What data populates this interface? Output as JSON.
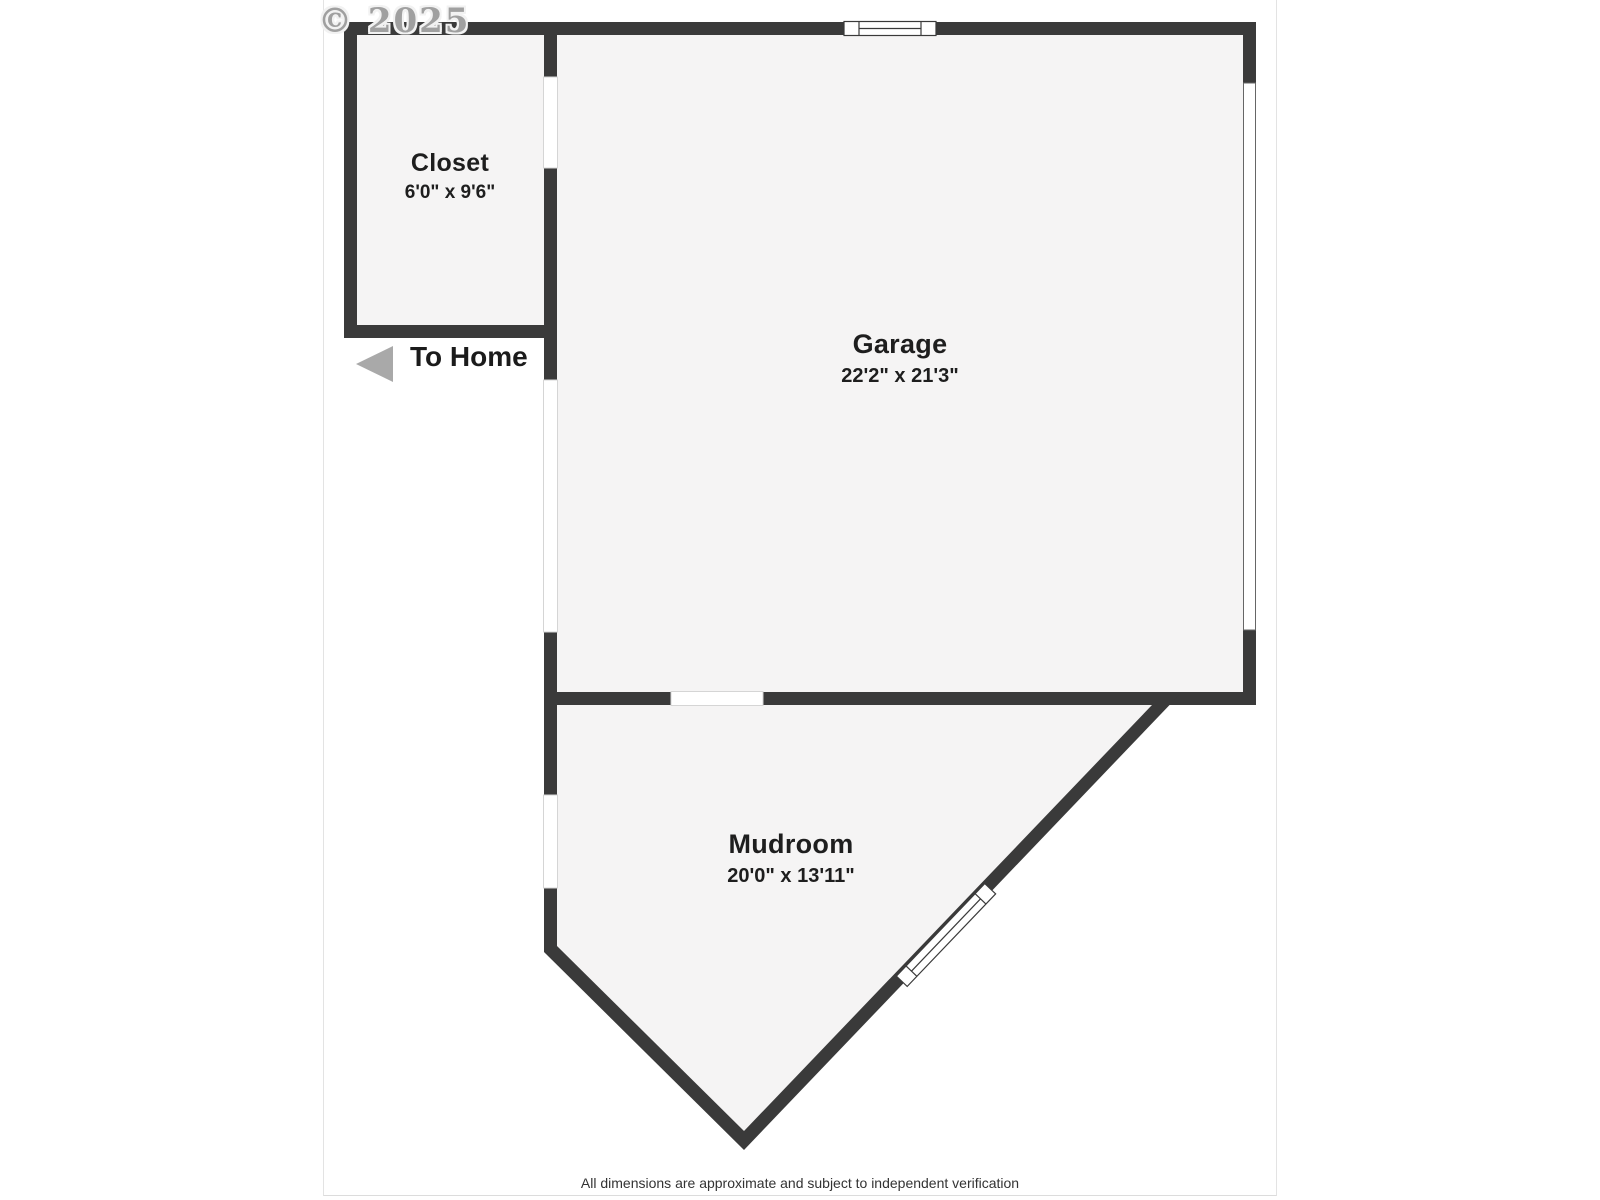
{
  "watermark": "© 2025",
  "rooms": {
    "closet": {
      "name": "Closet",
      "dimensions": "6'0\" x 9'6\""
    },
    "garage": {
      "name": "Garage",
      "dimensions": "22'2\" x 21'3\""
    },
    "mudroom": {
      "name": "Mudroom",
      "dimensions": "20'0\" x 13'11\""
    }
  },
  "annotations": {
    "to_home": "To Home"
  },
  "footer": {
    "disclaimer": "All dimensions are approximate and subject to independent verification"
  },
  "colors": {
    "wall": "#3a3a3a",
    "room_fill": "#f5f4f4",
    "arrow": "#a9a9a9",
    "watermark_text": "#a0a0a0",
    "footer_text": "#333333"
  }
}
